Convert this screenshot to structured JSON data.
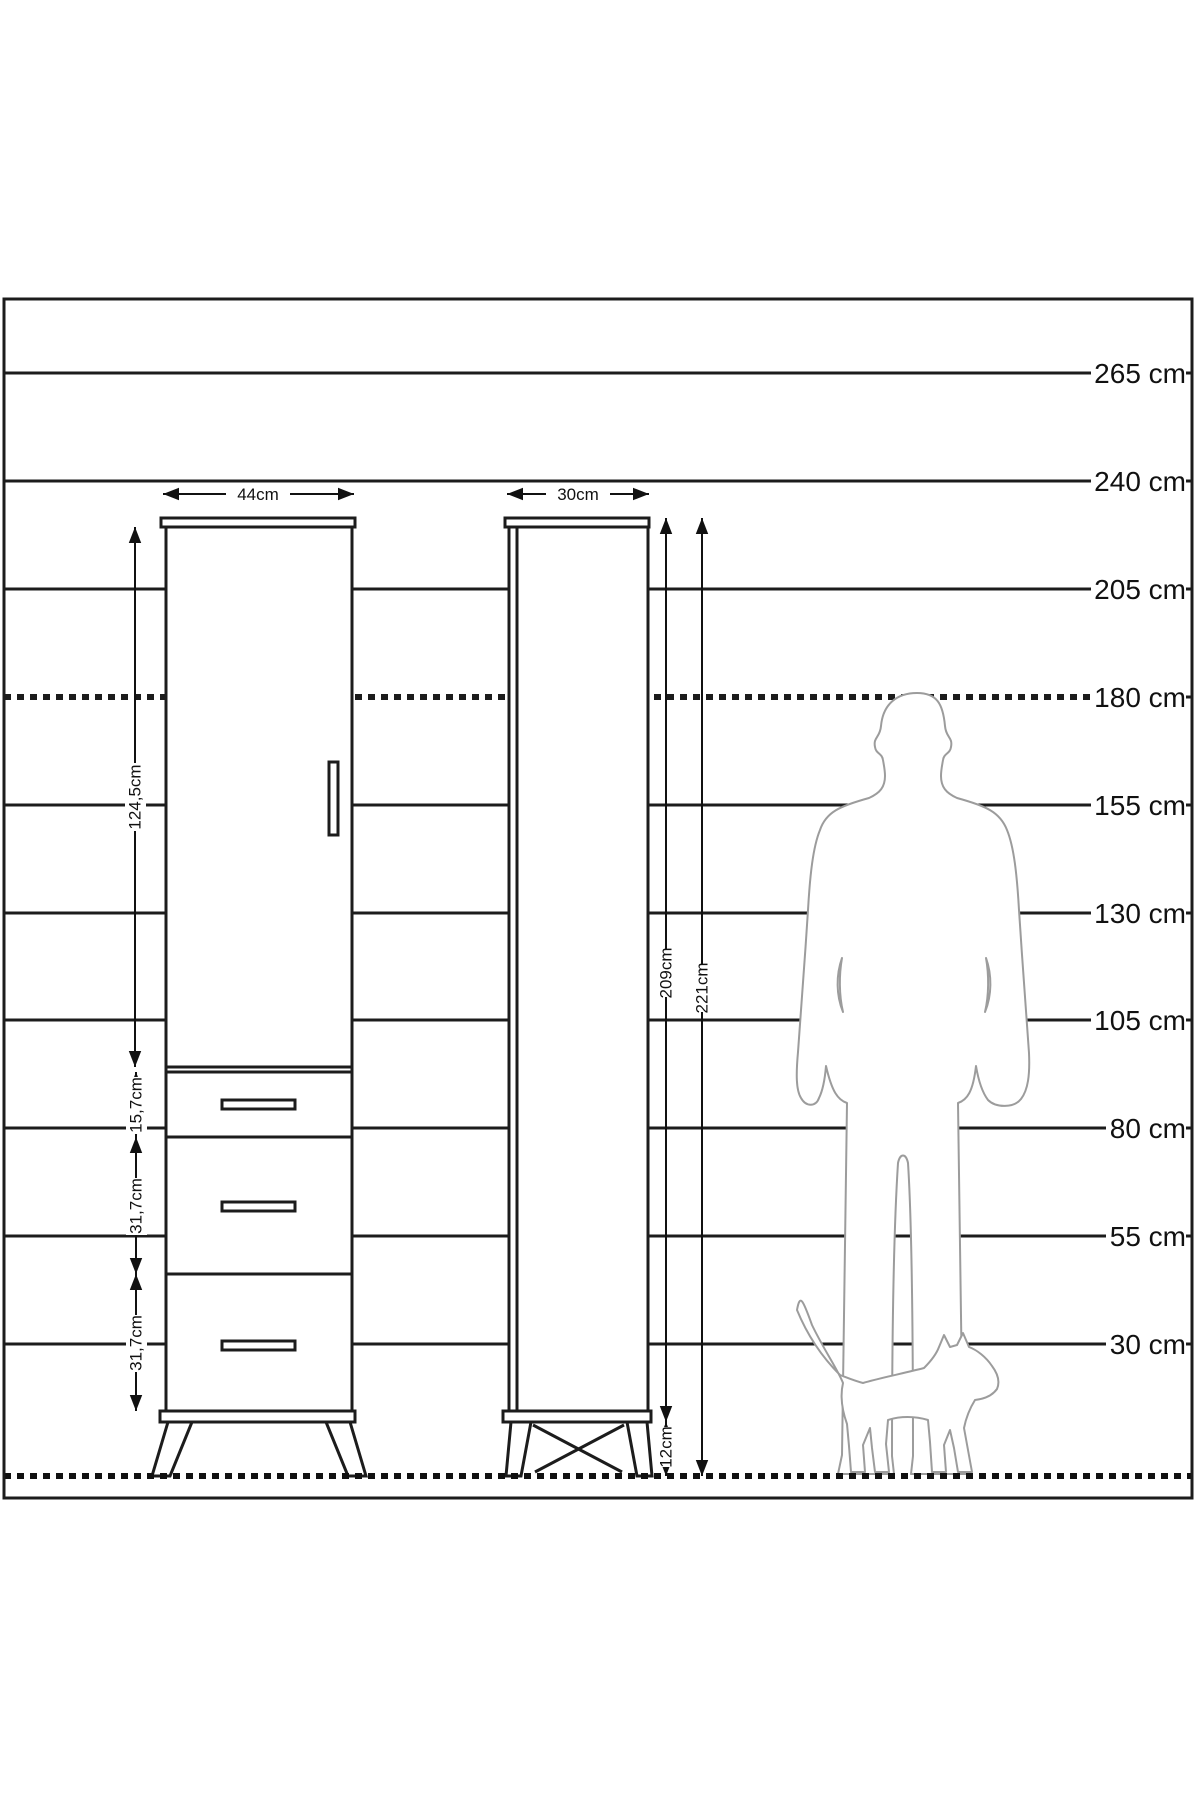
{
  "colors": {
    "line": "#1c1c1c",
    "silhouette_outline": "#9c9c9c",
    "background": "#ffffff"
  },
  "diagram": {
    "type": "furniture-dimension-diagram",
    "scale": {
      "unit": "cm",
      "lines": [
        {
          "label": "265 cm",
          "value": 265,
          "style": "solid"
        },
        {
          "label": "240 cm",
          "value": 240,
          "style": "solid"
        },
        {
          "label": "205 cm",
          "value": 205,
          "style": "solid"
        },
        {
          "label": "180 cm",
          "value": 180,
          "style": "dashed"
        },
        {
          "label": "155 cm",
          "value": 155,
          "style": "solid"
        },
        {
          "label": "130 cm",
          "value": 130,
          "style": "solid"
        },
        {
          "label": "105 cm",
          "value": 105,
          "style": "solid"
        },
        {
          "label": "80 cm",
          "value": 80,
          "style": "solid"
        },
        {
          "label": "55 cm",
          "value": 55,
          "style": "solid"
        },
        {
          "label": "30 cm",
          "value": 30,
          "style": "solid"
        }
      ]
    },
    "front_view": {
      "width_label": "44cm",
      "door_height_label": "124,5cm",
      "drawer1_height_label": "15,7cm",
      "drawer2_height_label": "31,7cm",
      "drawer3_height_label": "31,7cm"
    },
    "side_view": {
      "depth_label": "30cm",
      "body_height_label": "209cm",
      "total_height_label": "221cm",
      "leg_height_label": "12cm"
    },
    "figures": [
      {
        "name": "man-silhouette",
        "represents": "180 cm tall person"
      },
      {
        "name": "cat-silhouette",
        "represents": "house cat for scale"
      }
    ]
  }
}
